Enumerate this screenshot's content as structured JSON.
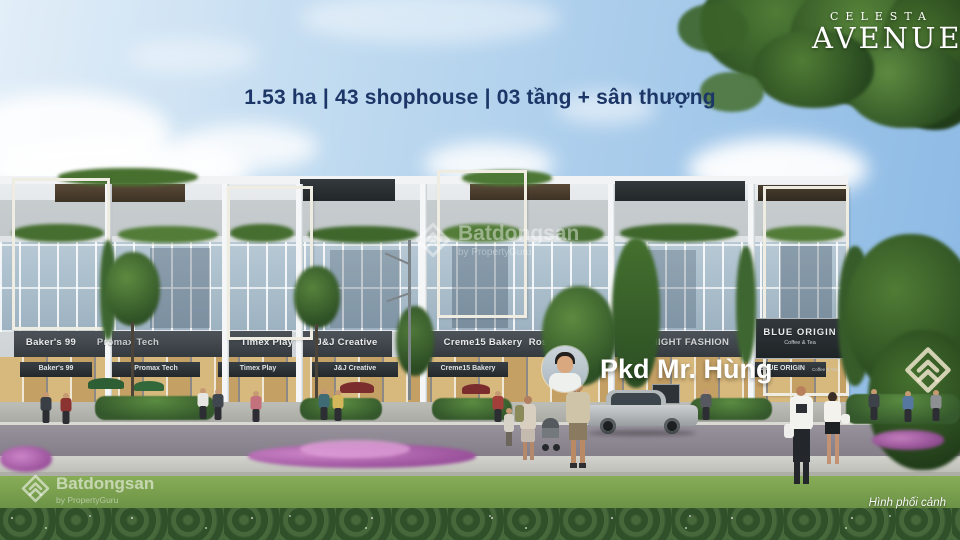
{
  "brand": {
    "line1": "CELESTA",
    "line2": "AVENUE"
  },
  "headline": "1.53 ha | 43 shophouse | 03 tầng + sân thượng",
  "agent_badge": {
    "name": "Pkd Mr. Hùng"
  },
  "caption": "Hình phối cảnh",
  "watermark": {
    "brand": "Batdongsan",
    "byline": "by PropertyGuru"
  },
  "signs": {
    "upper": [
      "Baker's 99",
      "Promax Tech",
      "Timex Play",
      "J&J Creative",
      "Creme15 Bakery",
      "Rose N Bloom",
      "NIGHT FASHION",
      "BLUE ORIGIN"
    ],
    "blue_origin_sub": "Coffee & Tea",
    "lower": [
      "Baker's 99",
      "Promax Tech",
      "Timex Play",
      "J&J Creative",
      "Creme15 Bakery",
      "BLUE ORIGIN"
    ],
    "lower_blue_origin_sub": "Coffee & Tea"
  },
  "colors": {
    "headline_navy": "#1c3767",
    "sign_band": "#3f464b",
    "sky_blue": "#8ab8e4",
    "lawn_green": "#77a24d",
    "watermark_white": "#ffffff"
  }
}
